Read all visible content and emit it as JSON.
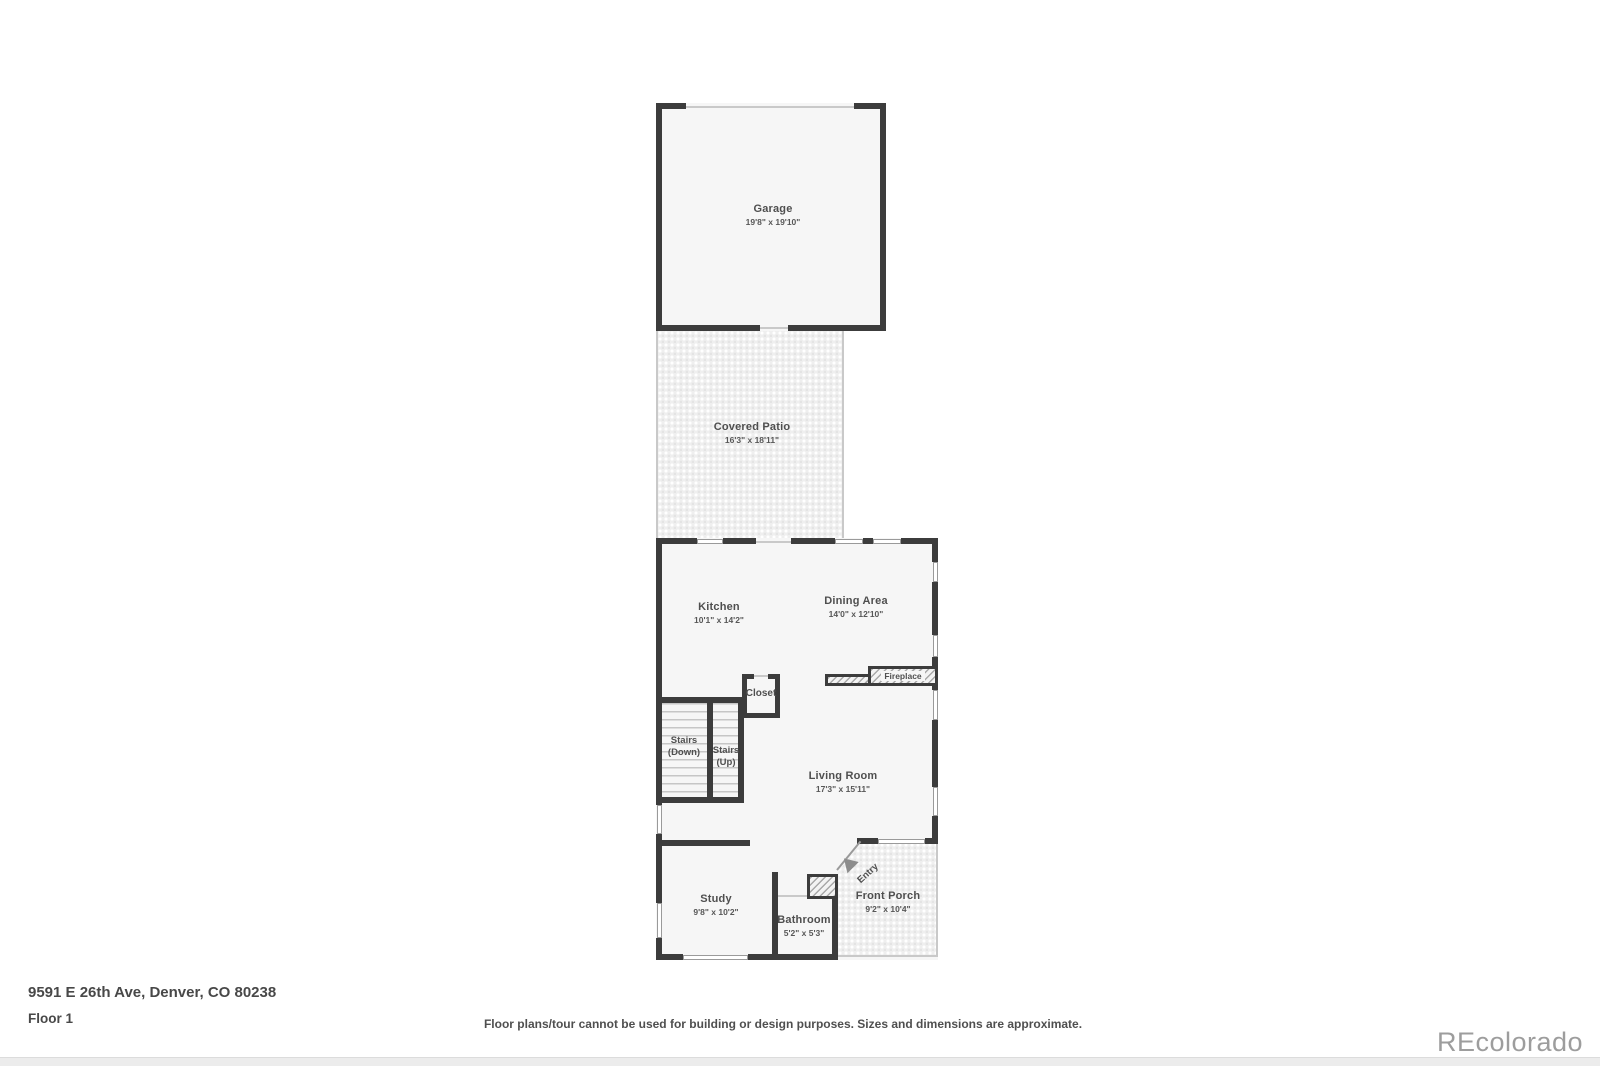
{
  "rooms": {
    "garage": {
      "name": "Garage",
      "dims": "19'8\" x 19'10\""
    },
    "covered_patio": {
      "name": "Covered Patio",
      "dims": "16'3\" x 18'11\""
    },
    "kitchen": {
      "name": "Kitchen",
      "dims": "10'1\" x 14'2\""
    },
    "dining": {
      "name": "Dining Area",
      "dims": "14'0\" x 12'10\""
    },
    "living": {
      "name": "Living Room",
      "dims": "17'3\" x 15'11\""
    },
    "study": {
      "name": "Study",
      "dims": "9'8\" x 10'2\""
    },
    "bathroom": {
      "name": "Bathroom",
      "dims": "5'2\" x 5'3\""
    },
    "front_porch": {
      "name": "Front Porch",
      "dims": "9'2\" x 10'4\""
    },
    "closet": {
      "name": "Closet"
    },
    "fireplace": {
      "name": "Fireplace"
    },
    "entry": {
      "name": "Entry"
    },
    "stairs_down": {
      "line1": "Stairs",
      "line2": "(Down)"
    },
    "stairs_up": {
      "line1": "Stairs",
      "line2": "(Up)"
    }
  },
  "footer": {
    "address": "9591 E 26th Ave, Denver, CO 80238",
    "floor": "Floor 1",
    "disclaimer": "Floor plans/tour cannot be used for building or design purposes. Sizes and dimensions are approximate.",
    "watermark": "REcolorado"
  },
  "colors": {
    "wall": "#3c3c3c",
    "room_fill": "#f6f6f6",
    "label_text": "#4f4f4f",
    "watermark_grey": "#9d9d9d"
  }
}
